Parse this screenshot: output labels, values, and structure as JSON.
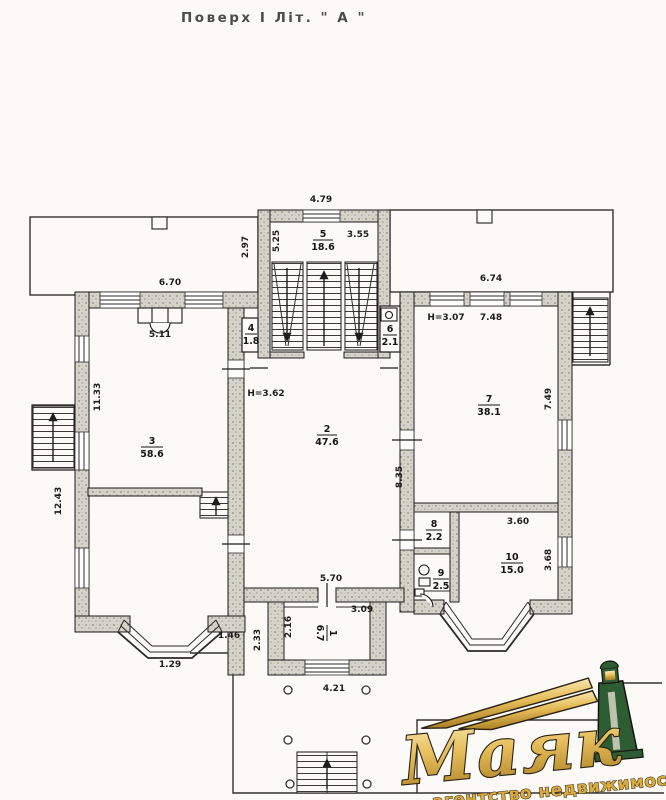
{
  "title": "Поверх І Літ. \" А \"",
  "rooms": {
    "r1": {
      "num": "1",
      "area": "6.7"
    },
    "r2": {
      "num": "2",
      "area": "47.6"
    },
    "r3": {
      "num": "3",
      "area": "58.6"
    },
    "r4": {
      "num": "4",
      "area": "1.8"
    },
    "r5": {
      "num": "5",
      "area": "18.6"
    },
    "r6": {
      "num": "6",
      "area": "2.1"
    },
    "r7": {
      "num": "7",
      "area": "38.1"
    },
    "r8": {
      "num": "8",
      "area": "2.2"
    },
    "r9": {
      "num": "9",
      "area": "2.5"
    },
    "r10": {
      "num": "10",
      "area": "15.0"
    }
  },
  "heights": {
    "room2": "Н=3.62",
    "room7": "Н=3.07"
  },
  "dims": {
    "stairhall_top": "4.79",
    "terrace_left": "2.97",
    "room5_depth": "5.25",
    "room5_width": "3.55",
    "left_wing_top": "6.70",
    "right_wing_top": "6.74",
    "fireplace": "5.11",
    "room7_top": "7.48",
    "room7_side": "7.49",
    "left_wall_upper": "11.33",
    "left_wall_lower": "12.43",
    "room2_side": "8.35",
    "room10_top": "3.60",
    "room10_side": "3.68",
    "room2_bottom": "5.70",
    "room1_top": "3.09",
    "room1_side": "2.16",
    "room1_outer": "2.33",
    "bay_offset": "1.46",
    "bay_front": "1.29",
    "porch": "4.21"
  },
  "logo": {
    "name": "Маяк",
    "tagline": "агентство недвижимости",
    "colors": {
      "gold": "#dcab3e",
      "gold_light": "#f8e7b0",
      "gold_dark": "#a87e22",
      "outline": "#2b2214",
      "green": "#2e5c33",
      "ink": "#1d1d1d",
      "paper": "#fbfaf6"
    }
  }
}
